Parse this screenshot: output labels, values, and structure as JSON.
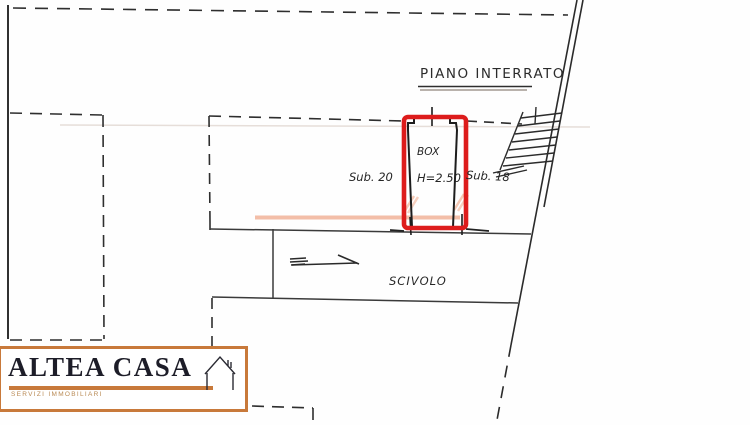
{
  "title": "PIANO INTERRATO",
  "labels": {
    "box": "BOX",
    "box_height": "H=2.50",
    "sub_left": "Sub. 20",
    "sub_right": "Sub. 18",
    "ramp": "SCIVOLO"
  },
  "logo": {
    "name": "ALTEA CASA",
    "tagline": "SERVIZI IMMOBILIARI",
    "icon": "house-outline-icon"
  },
  "colors": {
    "highlight_red": "#dd1c1c",
    "logo_orange": "#c8793a",
    "watermark_salmon": "#f0ae92",
    "ink": "#2e2e2e"
  }
}
